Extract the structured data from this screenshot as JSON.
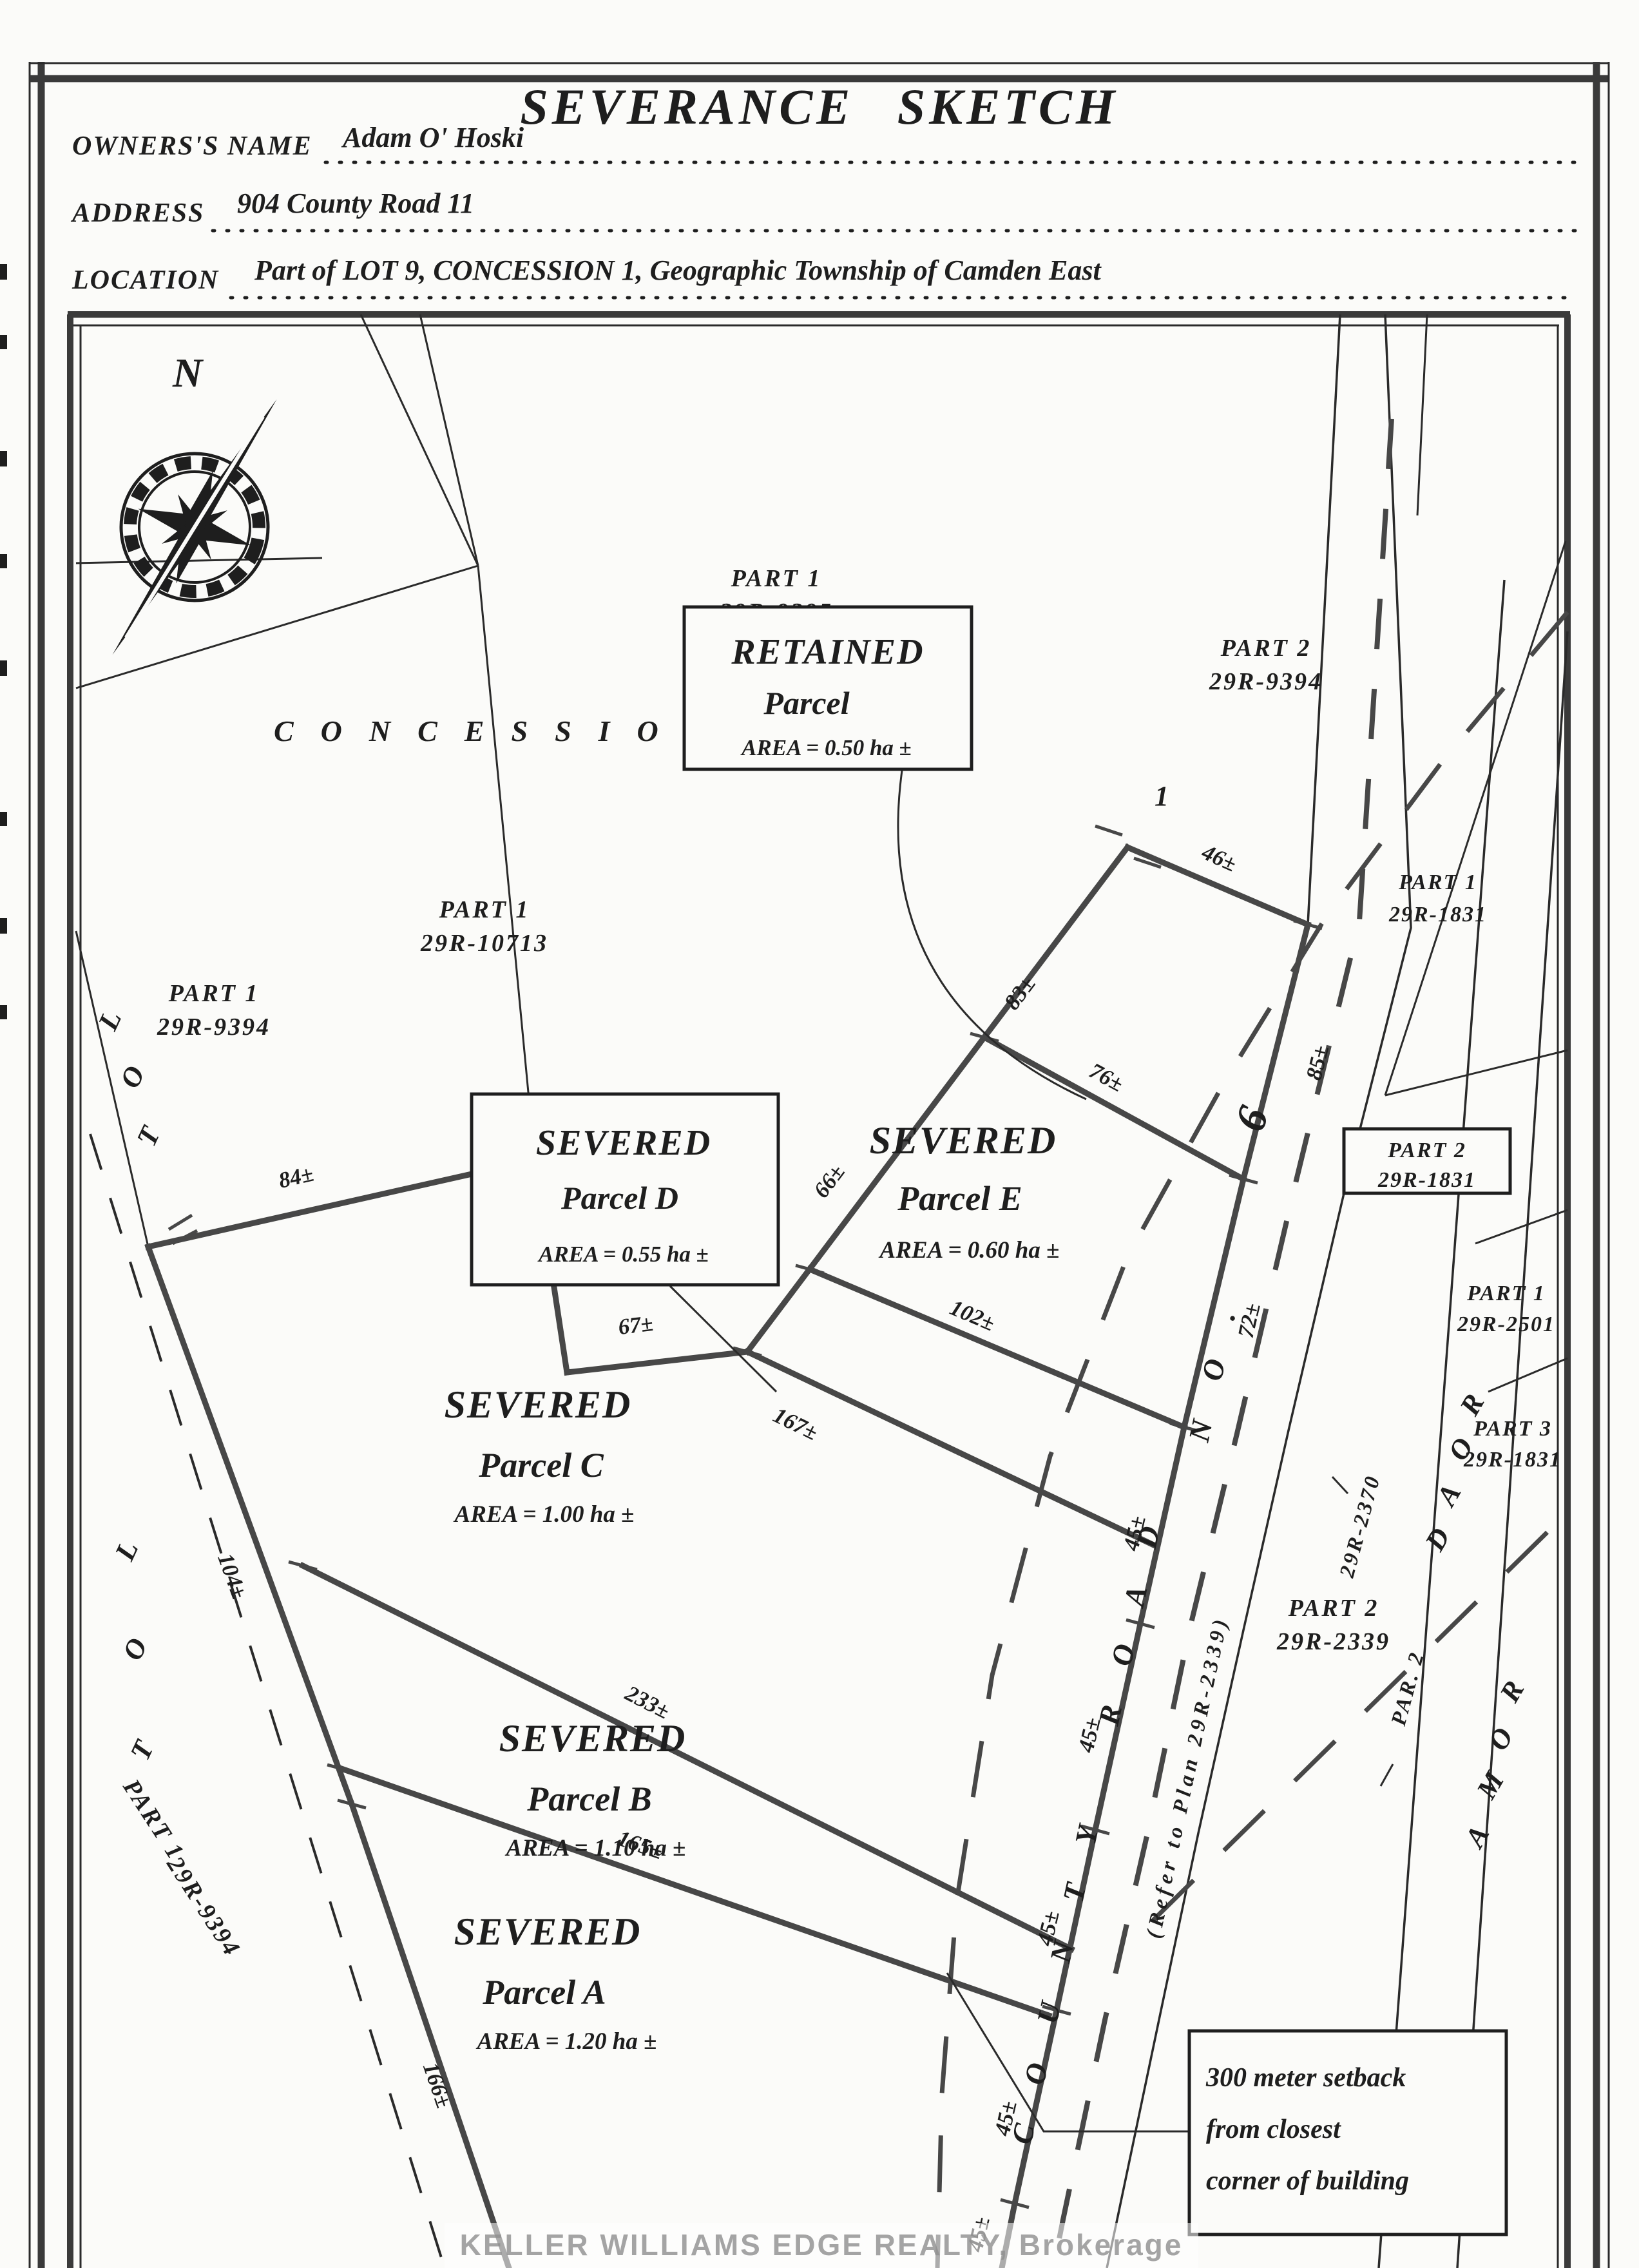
{
  "page": {
    "title": "SEVERANCE SKETCH",
    "watermark": "KELLER WILLIAMS EDGE REALTY, Brokerage"
  },
  "form": {
    "rows": [
      {
        "label": "OWNERS'S NAME",
        "value": "Adam O' Hoski"
      },
      {
        "label": "ADDRESS",
        "value": "904 County Road 11"
      },
      {
        "label": "LOCATION",
        "value": "Part of LOT 9, CONCESSION 1, Geographic Township of Camden East"
      }
    ]
  },
  "compass": {
    "north": "N"
  },
  "map": {
    "concession": "CONCESSION",
    "vertex": "1",
    "lot": [
      "L",
      "O",
      "T"
    ],
    "plan_labels": [
      {
        "l1": "PART 1",
        "l2": "29R-9395"
      },
      {
        "l1": "PART 2",
        "l2": "29R-9394"
      },
      {
        "l1": "PART 1",
        "l2": "29R-10713"
      },
      {
        "l1": "PART 1",
        "l2": "29R-9394"
      },
      {
        "l1": "PART 1",
        "l2": "29R-1831"
      },
      {
        "l1": "PART 1",
        "l2": "29R-2501"
      },
      {
        "l1": "PART 3",
        "l2": "29R-1831"
      },
      {
        "l1": "PART 2",
        "l2": "29R-2339"
      }
    ],
    "rotated_label": {
      "l1": "PART 1",
      "l2": "29R-9394"
    },
    "boxed_label": {
      "l1": "PART 2",
      "l2": "29R-1831"
    },
    "parcels": {
      "retained": {
        "l1": "RETAINED",
        "l2": "Parcel",
        "l3": "AREA = 0.50 ha ±"
      },
      "d": {
        "l1": "SEVERED",
        "l2": "Parcel D",
        "l3": "AREA = 0.55 ha ±"
      },
      "e": {
        "l1": "SEVERED",
        "l2": "Parcel E",
        "l3": "AREA = 0.60 ha ±"
      },
      "c": {
        "l1": "SEVERED",
        "l2": "Parcel C",
        "l3": "AREA = 1.00 ha ±"
      },
      "b": {
        "l1": "SEVERED",
        "l2": "Parcel B",
        "l3": "AREA = 1.10 ha ±"
      },
      "a": {
        "l1": "SEVERED",
        "l2": "Parcel A",
        "l3": "AREA = 1.20 ha ±"
      }
    },
    "setback_note": {
      "l1": "300 meter setback",
      "l2": "from closest",
      "l3": "corner of building"
    },
    "dims": {
      "d46": "46±",
      "d83": "83±",
      "d66": "66±",
      "d76": "76±",
      "d85": "85±",
      "d72": "72±",
      "d45": "45±",
      "d84": "84±",
      "d67": "67±",
      "d167": "167±",
      "d102": "102±",
      "d104": "104±",
      "d233": "233±",
      "d165": "165±",
      "d166": "166±"
    },
    "roads": {
      "county_1": "C O U N T Y",
      "county_2": "R O A D",
      "county_3": "N O .",
      "county_6": "6",
      "refer": "(Refer to Plan 29R-2339)",
      "par2_a": "PAR. 2",
      "par2_b": "29R-2370",
      "roma_upper": [
        "R",
        "O",
        "A",
        "D"
      ],
      "roma_lower": [
        "R",
        "O",
        "M",
        "A"
      ]
    }
  }
}
